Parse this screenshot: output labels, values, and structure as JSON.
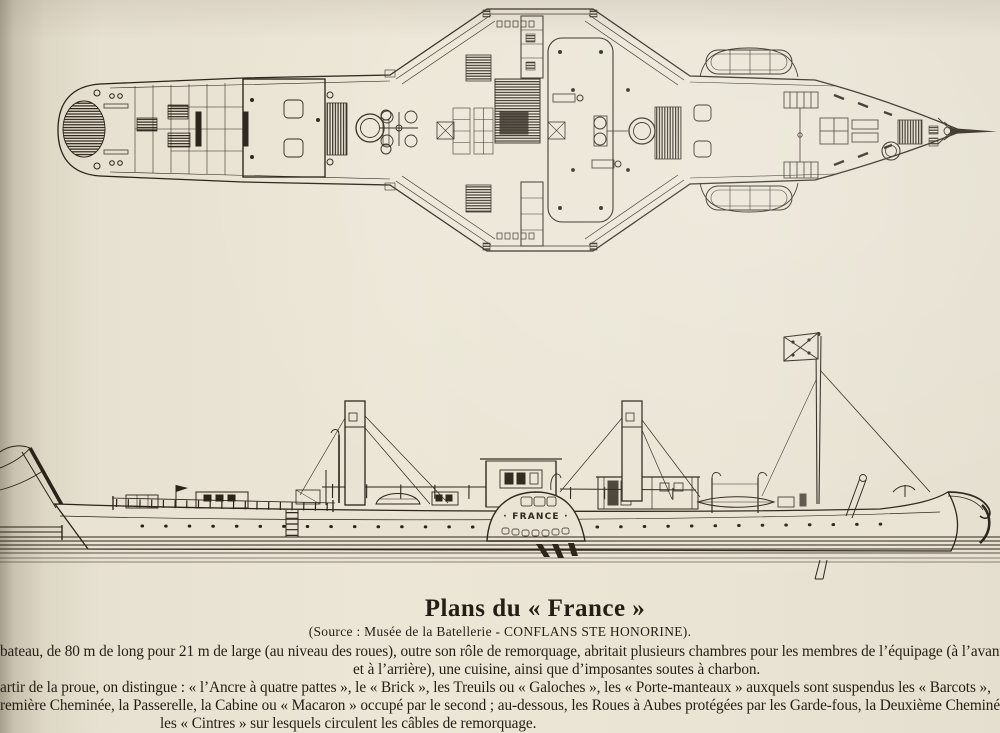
{
  "page": {
    "paper_color": "#e9e3d3",
    "ink_color": "#2a2318"
  },
  "drawing": {
    "ship_name_label": "· FRANCE ·"
  },
  "caption": {
    "title": "Plans du « France »",
    "source": "(Source : Musée de la Batellerie - CONFLANS STE HONORINE).",
    "lines": [
      "bateau, de 80 m de long pour 21 m de large (au niveau des roues), outre son rôle de remorquage, abritait plusieurs chambres pour les membres de l’équipage (à l’avant",
      "et à l’arrière), une cuisine, ainsi que d’imposantes soutes à charbon.",
      "artir de la proue, on distingue : « l’Ancre à quatre pattes », le « Brick », les Treuils ou « Galoches », les « Porte-manteaux » auxquels sont suspendus les « Barcots »,",
      "remière Cheminée, la Passerelle, la Cabine ou « Macaron » occupé par le second ; au-dessous, les Roues à Aubes protégées par les Garde-fous, la Deuxième Cheminée,",
      "les « Cintres » sur lesquels circulent les câbles de remorquage."
    ]
  }
}
